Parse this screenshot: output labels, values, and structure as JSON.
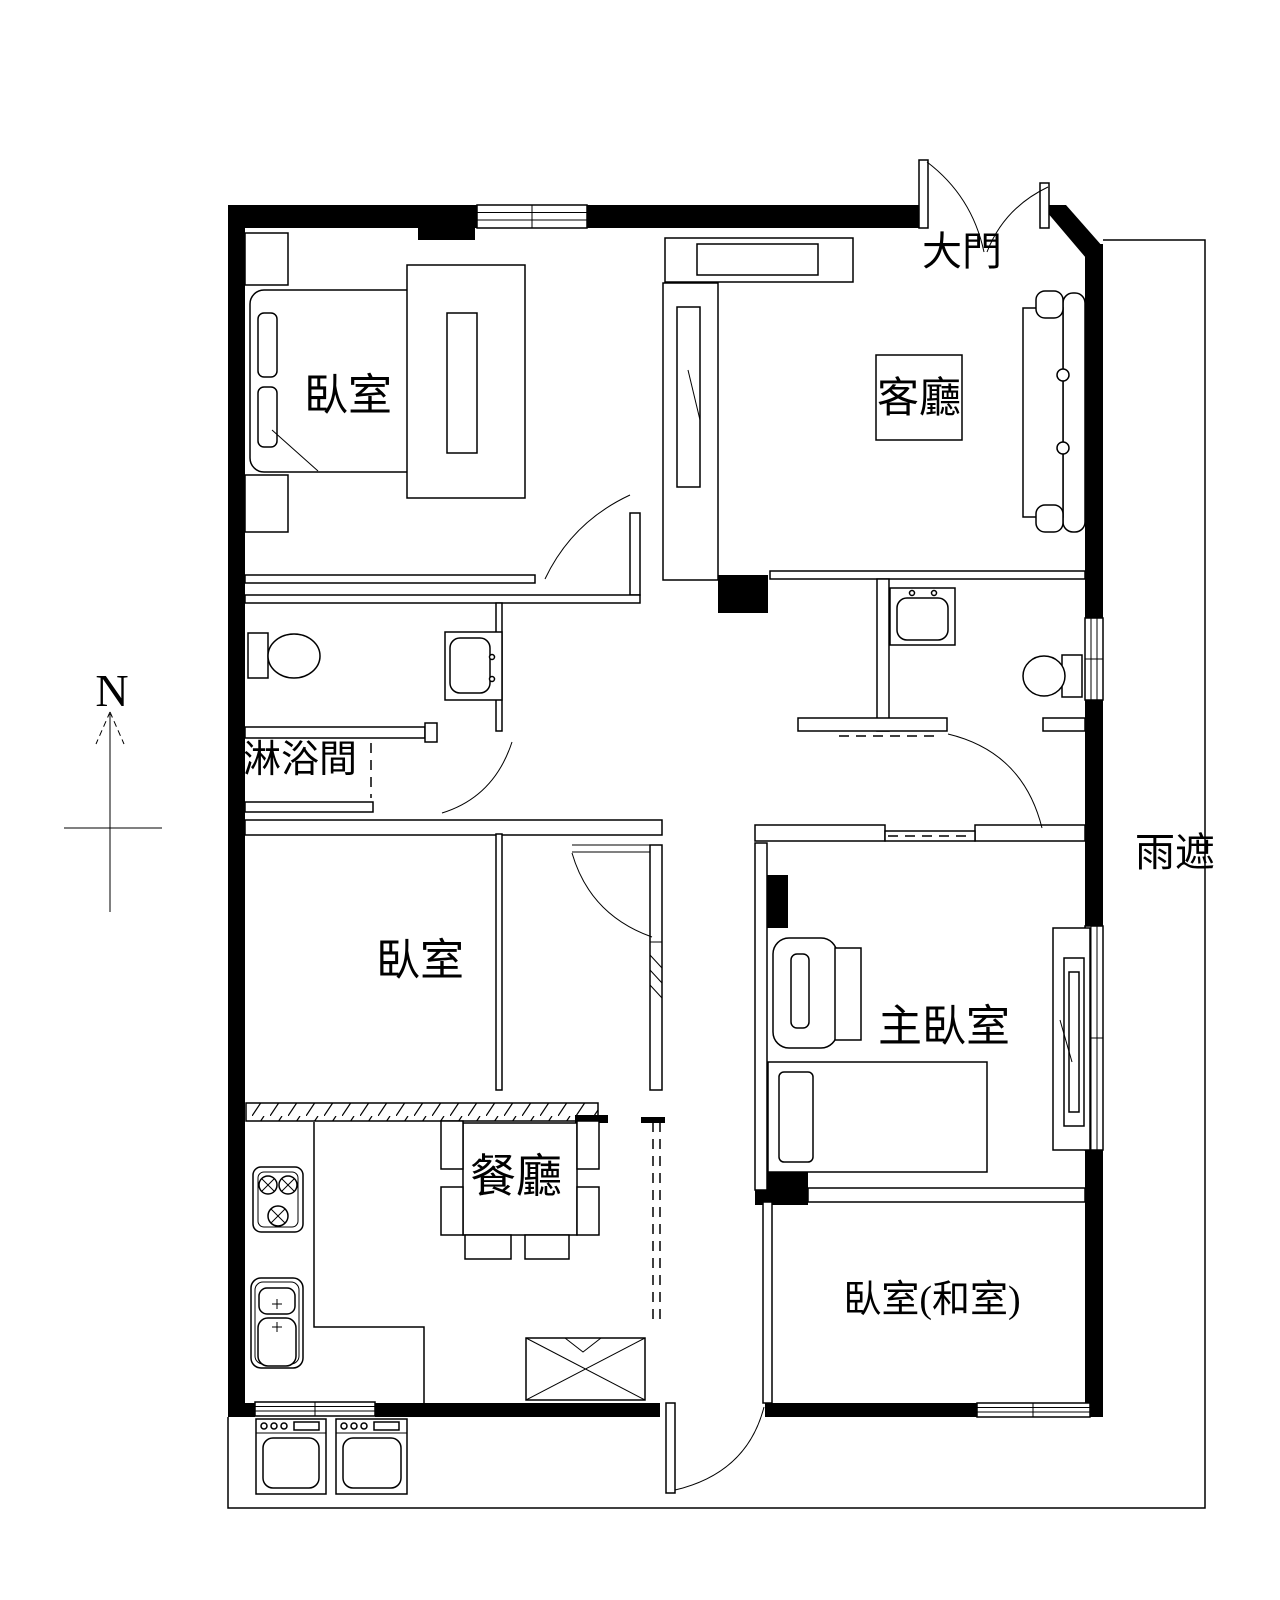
{
  "drawing": {
    "type": "apartment floor plan, black line drawing on white",
    "compass": {
      "north_letter": "N"
    }
  },
  "labels": {
    "bedroom1": "臥室",
    "living_room": "客廳",
    "main_door": "大門",
    "shower_room": "淋浴間",
    "bedroom2": "臥室",
    "master_bedroom": "主臥室",
    "dining_room": "餐廳",
    "bedroom_tatami": "臥室(和室)",
    "rain_shelter": "雨遮",
    "compass_north": "N"
  },
  "colors": {
    "line": "#000000",
    "background": "#ffffff"
  }
}
